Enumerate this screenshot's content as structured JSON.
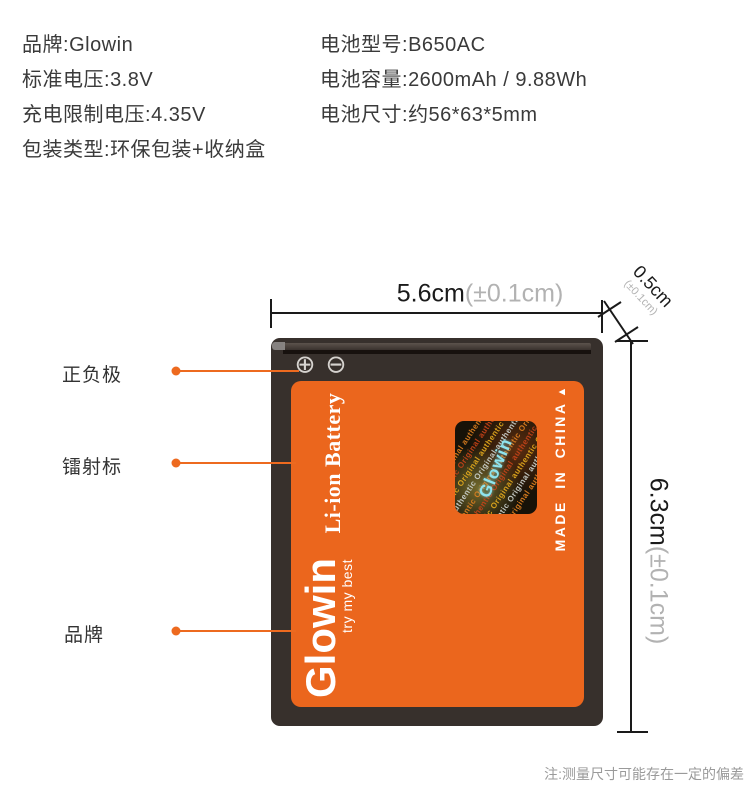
{
  "colors": {
    "accent_orange": "#EB661D",
    "leader_orange": "#ED6A1F",
    "battery_body": "#37302C",
    "dimension_line": "#1A1A1A",
    "tolerance_gray": "#B2B2B2",
    "spec_text": "#3A3A3A",
    "note_gray": "#9A9A9A",
    "hologram_cyan": "#8FE4EE"
  },
  "specs": {
    "left": [
      {
        "label": "品牌:",
        "value": "Glowin"
      },
      {
        "label": "标准电压:",
        "value": "3.8V"
      },
      {
        "label": "充电限制电压:",
        "value": "4.35V"
      },
      {
        "label": "包装类型:",
        "value": "环保包装+收纳盒"
      }
    ],
    "right": [
      {
        "label": "电池型号:",
        "value": "B650AC"
      },
      {
        "label": "电池容量:",
        "value": "2600mAh / 9.88Wh"
      },
      {
        "label": "电池尺寸:",
        "value": "约56*63*5mm"
      }
    ]
  },
  "dimensions": {
    "width": {
      "value": "5.6cm",
      "tolerance": "(±0.1cm)"
    },
    "height": {
      "value": "6.3cm",
      "tolerance": "(±0.1cm)"
    },
    "thickness": {
      "value": "0.5cm",
      "tolerance": "(±0.1cm)"
    }
  },
  "callouts": [
    {
      "label": "正负极"
    },
    {
      "label": "镭射标"
    },
    {
      "label": "品牌"
    }
  ],
  "battery": {
    "type_text": "Li-ion Battery",
    "brand": "Glowin",
    "slogan": "try my best",
    "origin": "MADE IN CHINA",
    "origin_arrow": "▲",
    "polarity_plus_icon": "⊕",
    "polarity_minus_icon": "⊖",
    "hologram": {
      "brand": "Glowin",
      "pattern_text": "Original authentic Original authentic Original authentic"
    }
  },
  "note": "注:测量尺寸可能存在一定的偏差"
}
